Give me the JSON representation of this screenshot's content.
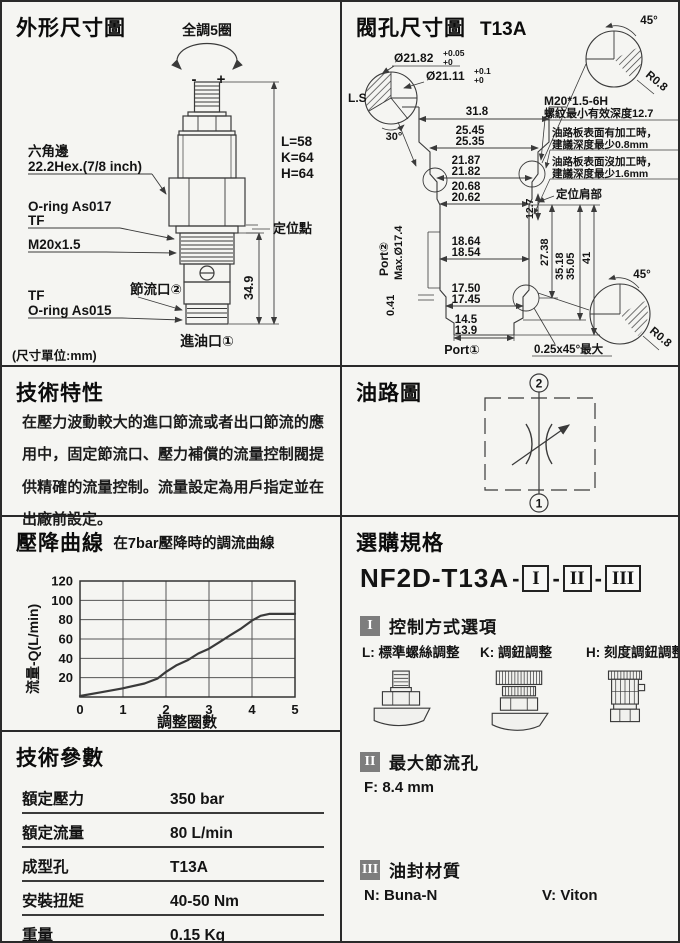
{
  "colors": {
    "line": "#3a3a3a",
    "border": "#2a2a2a",
    "badge_bg": "#7d7d7d",
    "panel_bg": "#f5f5f2"
  },
  "outline": {
    "title": "外形尺寸圖",
    "turns": "全調5圈",
    "minus": "-",
    "plus": "+",
    "hex1": "六角邊",
    "hex2": "22.2Hex.(7/8  inch)",
    "lkh1": "L=58",
    "lkh2": "K=64",
    "lkh3": "H=64",
    "oring_t1": "O-ring As017",
    "oring_t2": "TF",
    "locating": "定位點",
    "thread": "M20x1.5",
    "throttle": "節流口②",
    "oring_b1": "TF",
    "oring_b2": "O-ring As015",
    "dim_h": "34.9",
    "inlet": "進油口①",
    "unit": "(尺寸單位:mm)"
  },
  "cavity": {
    "title": "閥孔尺寸圖",
    "code": "T13A",
    "ls": "L.S",
    "dia1": "Ø21.82",
    "dia1t": "+0.05",
    "dia1b": "+0",
    "dia2": "Ø21.11",
    "dia2t": "+0.1",
    "dia2b": "+0",
    "a30": "30°",
    "a45": "45°",
    "r08": "R0.8",
    "d318": "31.8",
    "d2545": "25.45",
    "d2535": "25.35",
    "d2187": "21.87",
    "d2182": "21.82",
    "d2068": "20.68",
    "d2062": "20.62",
    "d1864": "18.64",
    "d1854": "18.54",
    "d1750": "17.50",
    "d1745": "17.45",
    "d145": "14.5",
    "d139": "13.9",
    "d127": "12.7",
    "d2738": "27.38",
    "d3518": "35.18",
    "d3505": "35.05",
    "d41": "41",
    "d041": "0.41",
    "maxdia": "Max.Ø17.4",
    "thread1": "M20*1.5-6H",
    "thread2": "螺紋最小有效深度12.7",
    "note1a": "油路板表面有加工時，",
    "note1b": "建議深度最少0.8mm",
    "note2a": "油路板表面沒加工時，",
    "note2b": "建議深度最少1.6mm",
    "shoulder": "定位肩部",
    "port2": "Port②",
    "port1": "Port①",
    "chamfer": "0.25x45°最大"
  },
  "features": {
    "title": "技術特性",
    "body": "在壓力波動較大的進口節流或者出口節流的應用中，固定節流口、壓力補償的流量控制閥提供精確的流量控制。流量設定為用戶指定並在出廠前設定。"
  },
  "circuit": {
    "title": "油路圖",
    "top": "2",
    "bottom": "1"
  },
  "curve": {
    "title": "壓降曲線"
  },
  "chart_data": {
    "type": "line",
    "title": "在7bar壓降時的調流曲線",
    "xlabel": "調整圈數",
    "ylabel": "流量-Q(L/min)",
    "xlim": [
      0,
      5
    ],
    "ylim": [
      0,
      120
    ],
    "xtick_step": 1,
    "ytick_step": 20,
    "grid": true,
    "legend": "none",
    "x": [
      0,
      0.5,
      1,
      1.5,
      1.8,
      2,
      2.25,
      2.5,
      2.75,
      3,
      3.25,
      3.5,
      3.75,
      4,
      4.2,
      4.4,
      4.6,
      5
    ],
    "y": [
      1,
      5,
      9,
      14,
      19,
      26,
      33,
      38,
      45,
      50,
      57,
      64,
      71,
      79,
      84,
      86,
      86,
      86
    ]
  },
  "ordering": {
    "title": "選購規格",
    "model_base": "NF2D-T13A",
    "dash": "-",
    "seg1": "I",
    "seg2": "II",
    "seg3": "III",
    "section1": {
      "badge": "I",
      "heading": "控制方式選項",
      "options": [
        {
          "label": "L: 標準螺絲調整"
        },
        {
          "label": "K: 調鈕調整"
        },
        {
          "label": "H: 刻度調鈕調整"
        }
      ]
    },
    "section2": {
      "badge": "II",
      "heading": "最大節流孔",
      "value": "F: 8.4 mm"
    },
    "section3": {
      "badge": "III",
      "heading": "油封材質",
      "n_label": "N: Buna-N",
      "v_label": "V: Viton"
    }
  },
  "params": {
    "title": "技術參數",
    "rows": [
      {
        "label": "額定壓力",
        "value": "350 bar"
      },
      {
        "label": "額定流量",
        "value": "80 L/min"
      },
      {
        "label": "成型孔",
        "value": "T13A"
      },
      {
        "label": "安裝扭矩",
        "value": "40-50 Nm"
      },
      {
        "label": "重量",
        "value": "0.15 Kg"
      }
    ]
  }
}
